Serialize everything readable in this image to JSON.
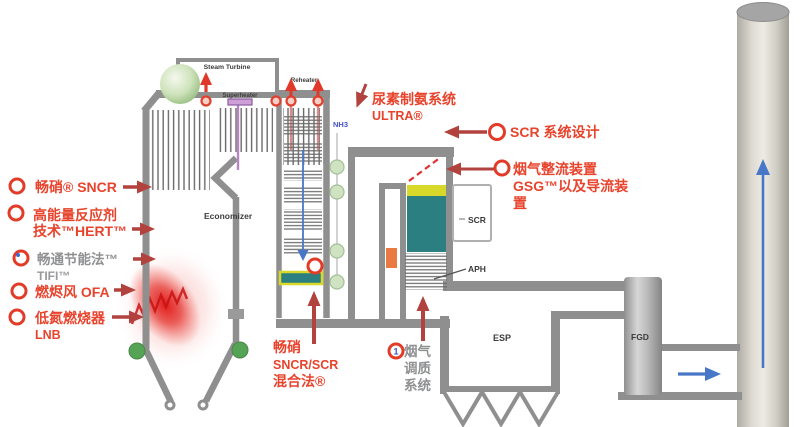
{
  "colors": {
    "label_red": "#e8432c",
    "arrow_brick": "#b2423e",
    "arrow_bright": "#e0392a",
    "wall_gray": "#8f8f8f",
    "catalyst_teal": "#2b7f80",
    "catalyst_yellow": "#d8d82a",
    "flow_blue": "#4877c8",
    "nh3_blue": "#4653c4",
    "muted_gray": "#8f9092",
    "damper_orange": "#e87a42",
    "nozzle_green": "#cfe2c2",
    "hopper_dot_green": "#55a455",
    "flame_red": "#e11616"
  },
  "left_labels": [
    {
      "lines": [
        "畅硝® SNCR"
      ]
    },
    {
      "lines": [
        "高能量反应剂",
        "技术™HERT™"
      ]
    },
    {
      "lines": [
        "畅通节能法™",
        "TIFI™"
      ]
    },
    {
      "lines": [
        "燃烬风 OFA"
      ]
    },
    {
      "lines": [
        "低氮燃烧器",
        "LNB"
      ]
    }
  ],
  "callouts": {
    "urea_line1": "尿素制氨系统",
    "urea_line2": "ULTRA®",
    "nh3": "NH3",
    "scr_design": "SCR 系统设计",
    "gsg_line1": "烟气整流装置",
    "gsg_line2": "GSG™以及导流装",
    "gsg_line3": "置",
    "hybrid_line1": "畅硝",
    "hybrid_line2": "SNCR/SCR",
    "hybrid_line3": "混合法®",
    "fgc_badge": "1",
    "fgc_line1": "烟气",
    "fgc_line2": "调质",
    "fgc_line3": "系统"
  },
  "equipment": {
    "steam_turbine": "Steam Turbine",
    "superheater": "Superheater",
    "reheater": "Reheater",
    "economizer": "Economizer",
    "scr": "SCR",
    "aph": "APH",
    "esp": "ESP",
    "fgd": "FGD"
  }
}
